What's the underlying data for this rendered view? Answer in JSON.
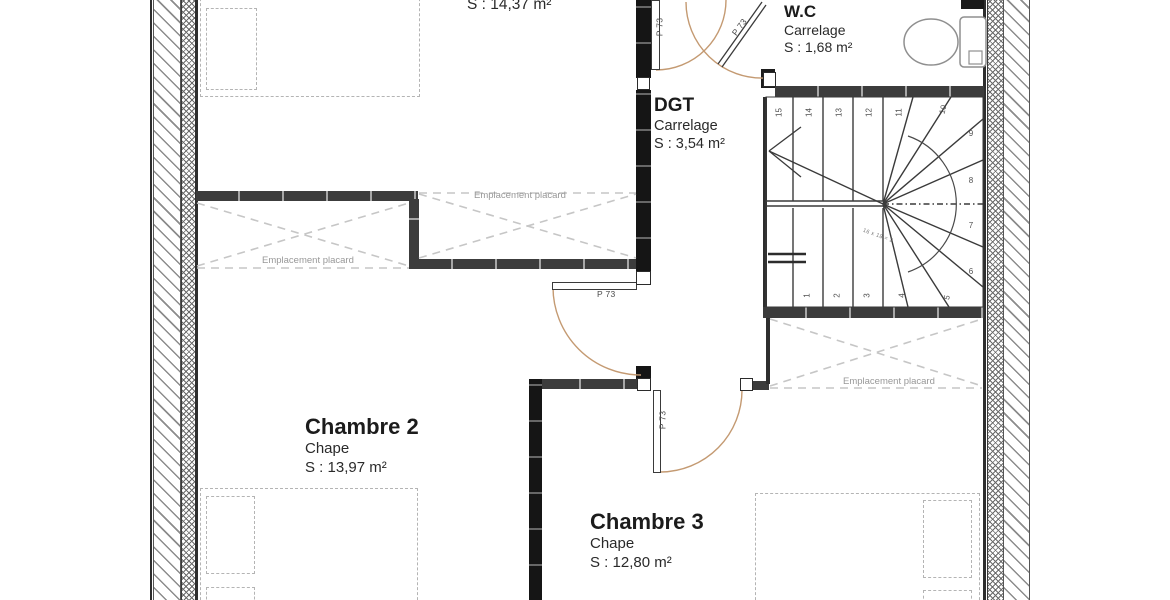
{
  "plan": {
    "rooms": [
      {
        "key": "room1",
        "name": "",
        "floor": "",
        "area": "S : 14,37 m²"
      },
      {
        "key": "wc",
        "name": "W.C",
        "floor": "Carrelage",
        "area": "S : 1,68 m²"
      },
      {
        "key": "dgt",
        "name": "DGT",
        "floor": "Carrelage",
        "area": "S : 3,54 m²"
      },
      {
        "key": "chambre2",
        "name": "Chambre 2",
        "floor": "Chape",
        "area": "S : 13,97 m²"
      },
      {
        "key": "chambre3",
        "name": "Chambre 3",
        "floor": "Chape",
        "area": "S : 12,80 m²"
      }
    ],
    "closet_label": "Emplacement placard",
    "door_label": "P 73",
    "stair": {
      "numbers": [
        "1",
        "2",
        "3",
        "4",
        "5",
        "6",
        "7",
        "8",
        "9",
        "10",
        "11",
        "12",
        "13",
        "14",
        "15"
      ],
      "annotation": "16 x 18 = 2"
    },
    "colors": {
      "door_arc": "#c49a72",
      "wall_dark": "#151515",
      "wall_gray": "#3c3c3c",
      "furniture_dash": "#b4b4b4",
      "closet_text": "#989898"
    }
  }
}
